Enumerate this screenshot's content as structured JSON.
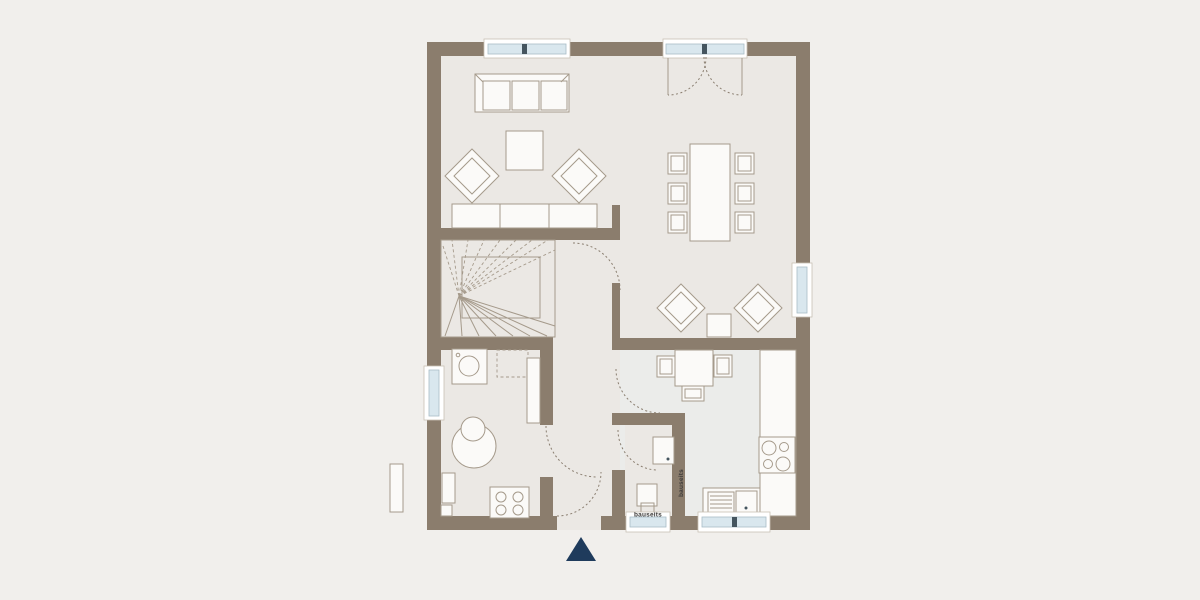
{
  "title": "ground-floor-plan",
  "labels": {
    "bauseits_vertical": "bauseits",
    "bauseits_horizontal": "bauseits"
  },
  "icons": {
    "entrance_marker": "navy upward triangle at entrance",
    "washer_icon": "square with drum circle",
    "cooktop_icon": "square with four burner circles",
    "sink_icon": "square basin with drain dot"
  },
  "colors": {
    "bg": "#f1efec",
    "floor": "#ebe8e4",
    "kitchen_floor": "#ebecea",
    "wall": "#8b7d6d",
    "line": "#a59a8b",
    "furniture": "#fbfaf8",
    "glass": "#d9e7ee",
    "glass_line": "#a9bdc7",
    "dash": "#8a7e70",
    "tick": "#45555f",
    "accent": "#1f3b5c",
    "text": "#3c3a38",
    "frame": "#c9c1b4"
  }
}
